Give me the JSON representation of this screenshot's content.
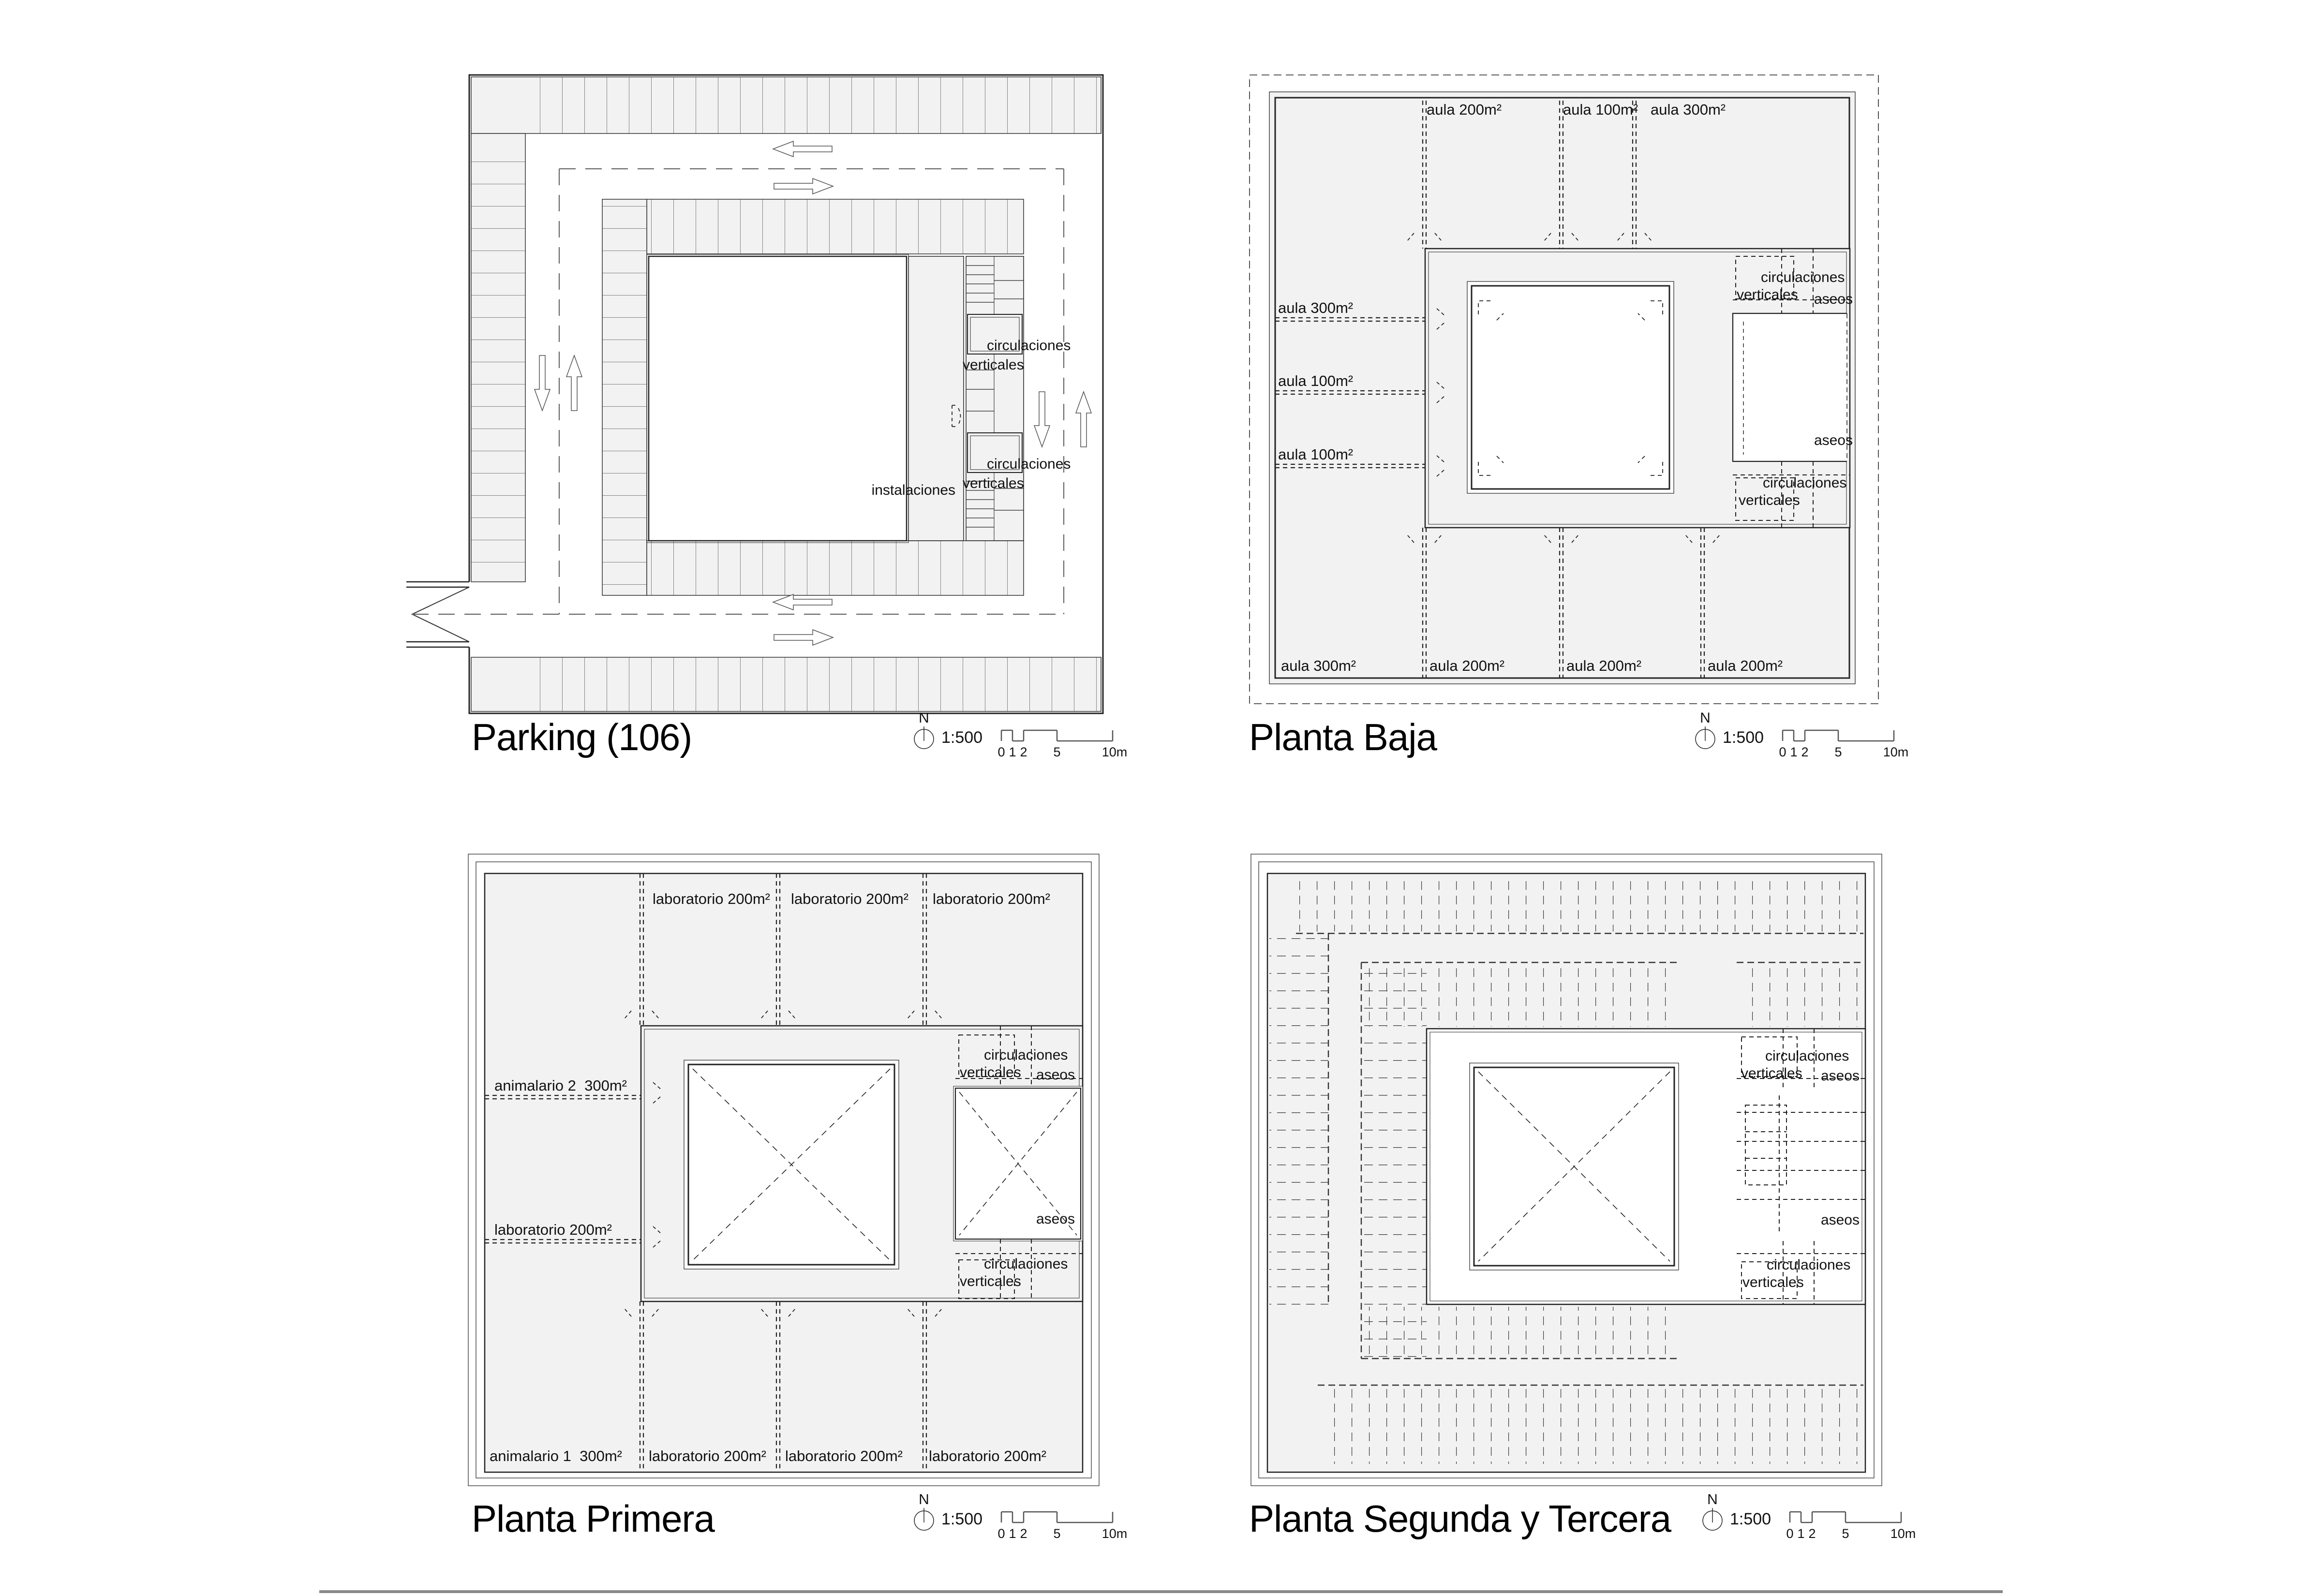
{
  "common": {
    "north": "N",
    "scale_ratio": "1:500",
    "scale_ticks": [
      "0",
      "1",
      "2",
      "5",
      "10m"
    ],
    "circulaciones_line1": "circulaciones",
    "circulaciones_line2": "verticales",
    "aseos": "aseos"
  },
  "parking": {
    "title": "Parking (106)",
    "instalaciones": "instalaciones"
  },
  "baja": {
    "title": "Planta Baja",
    "top_labels": [
      "aula 200m²",
      "aula 100m²",
      "aula 300m²"
    ],
    "left_labels": [
      "aula 300m²",
      "aula 100m²",
      "aula 100m²"
    ],
    "bottom_labels": [
      "aula 300m²",
      "aula 200m²",
      "aula 200m²",
      "aula 200m²"
    ]
  },
  "primera": {
    "title": "Planta Primera",
    "top_labels": [
      "laboratorio 200m²",
      "laboratorio 200m²",
      "laboratorio 200m²"
    ],
    "left_labels": [
      "animalario 2  300m²",
      "laboratorio 200m²"
    ],
    "bottom_labels": [
      "animalario 1  300m²",
      "laboratorio 200m²",
      "laboratorio 200m²",
      "laboratorio 200m²"
    ]
  },
  "segunda": {
    "title": "Planta Segunda y Tercera"
  }
}
